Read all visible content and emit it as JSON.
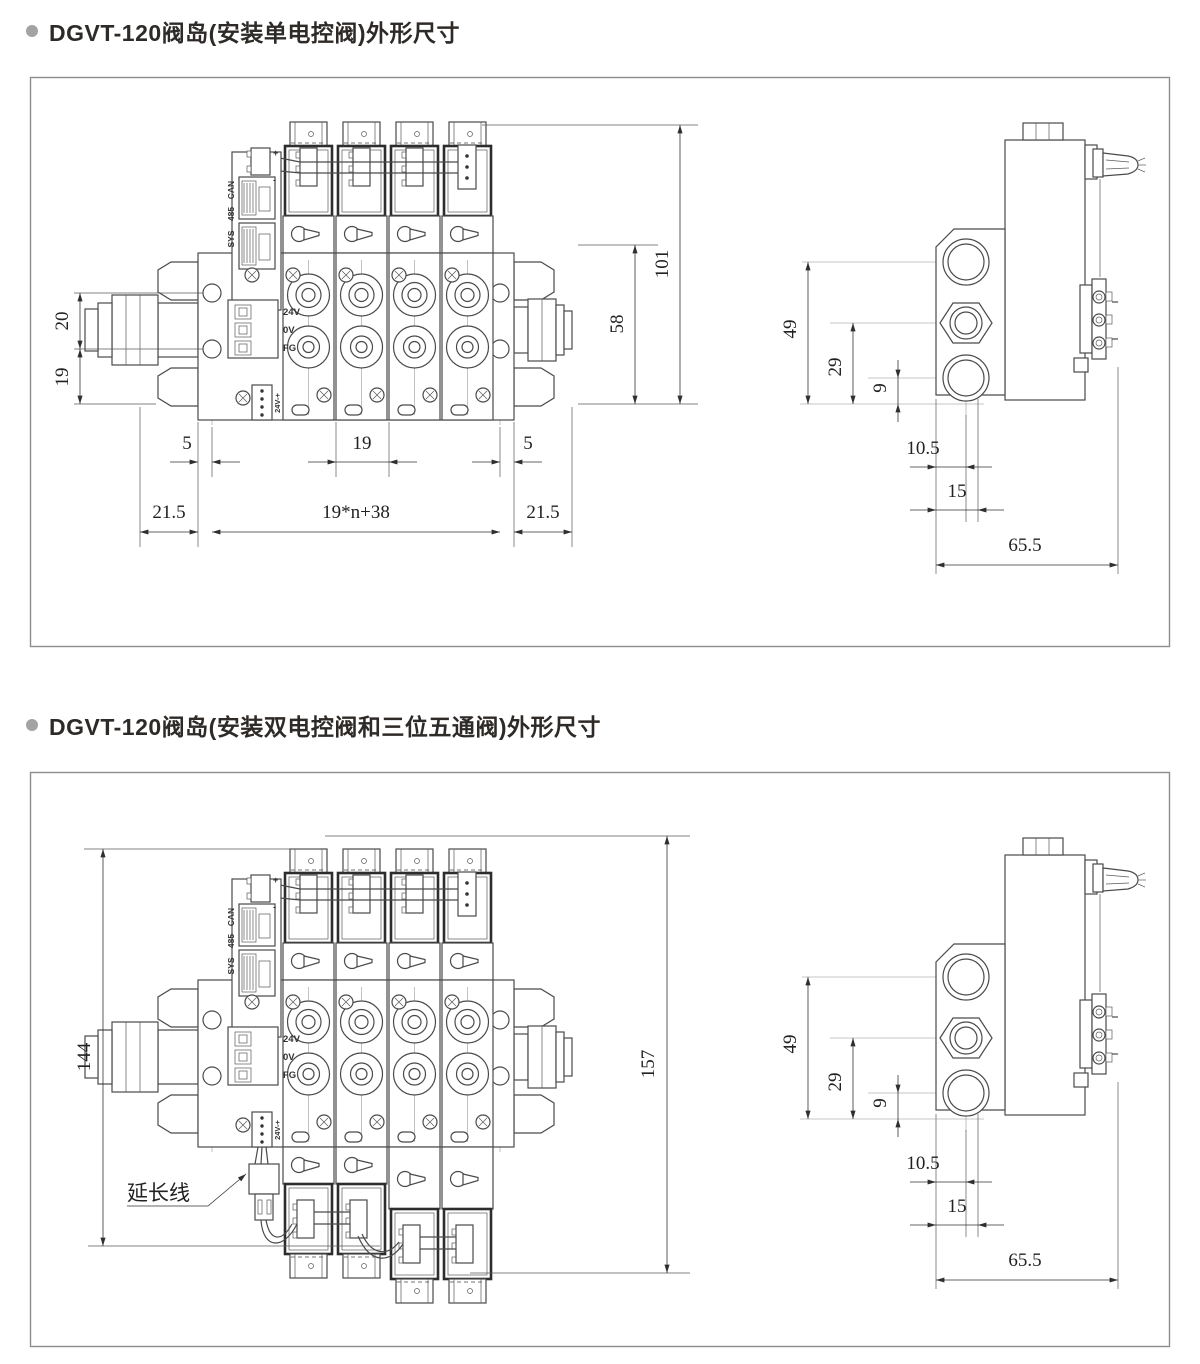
{
  "panel1": {
    "heading": "DGVT-120阀岛(安装单电控阀)外形尺寸",
    "front": {
      "dims": {
        "left_top": "20",
        "left_bottom": "19",
        "right_outer": "101",
        "right_inner": "58",
        "pitch_left": "5",
        "pitch_mid": "19",
        "pitch_right": "5",
        "bottom_left": "21.5",
        "bottom_mid": "19*n+38",
        "bottom_right": "21.5"
      },
      "labels": {
        "bus_can": "CAN",
        "bus_485": "485",
        "bus_sys": "SYS",
        "t_24v": "24V",
        "t_0v": "0V",
        "t_fg": "FG",
        "power": "24V-+",
        "plus": "+",
        "minus": "-"
      }
    },
    "side": {
      "dims": {
        "v1": "49",
        "v2": "29",
        "v3": "9",
        "h1": "10.5",
        "h2": "15",
        "h3": "65.5"
      }
    }
  },
  "panel2": {
    "heading": "DGVT-120阀岛(安装双电控阀和三位五通阀)外形尺寸",
    "front": {
      "dims": {
        "left": "144",
        "right": "157"
      },
      "labels": {
        "bus_can": "CAN",
        "bus_485": "485",
        "bus_sys": "SYS",
        "t_24v": "24V",
        "t_0v": "0V",
        "t_fg": "FG",
        "power": "24V-+",
        "plus": "+",
        "minus": "-",
        "extension": "延长线"
      }
    },
    "side": {
      "dims": {
        "v1": "49",
        "v2": "29",
        "v3": "9",
        "h1": "10.5",
        "h2": "15",
        "h3": "65.5"
      }
    }
  }
}
